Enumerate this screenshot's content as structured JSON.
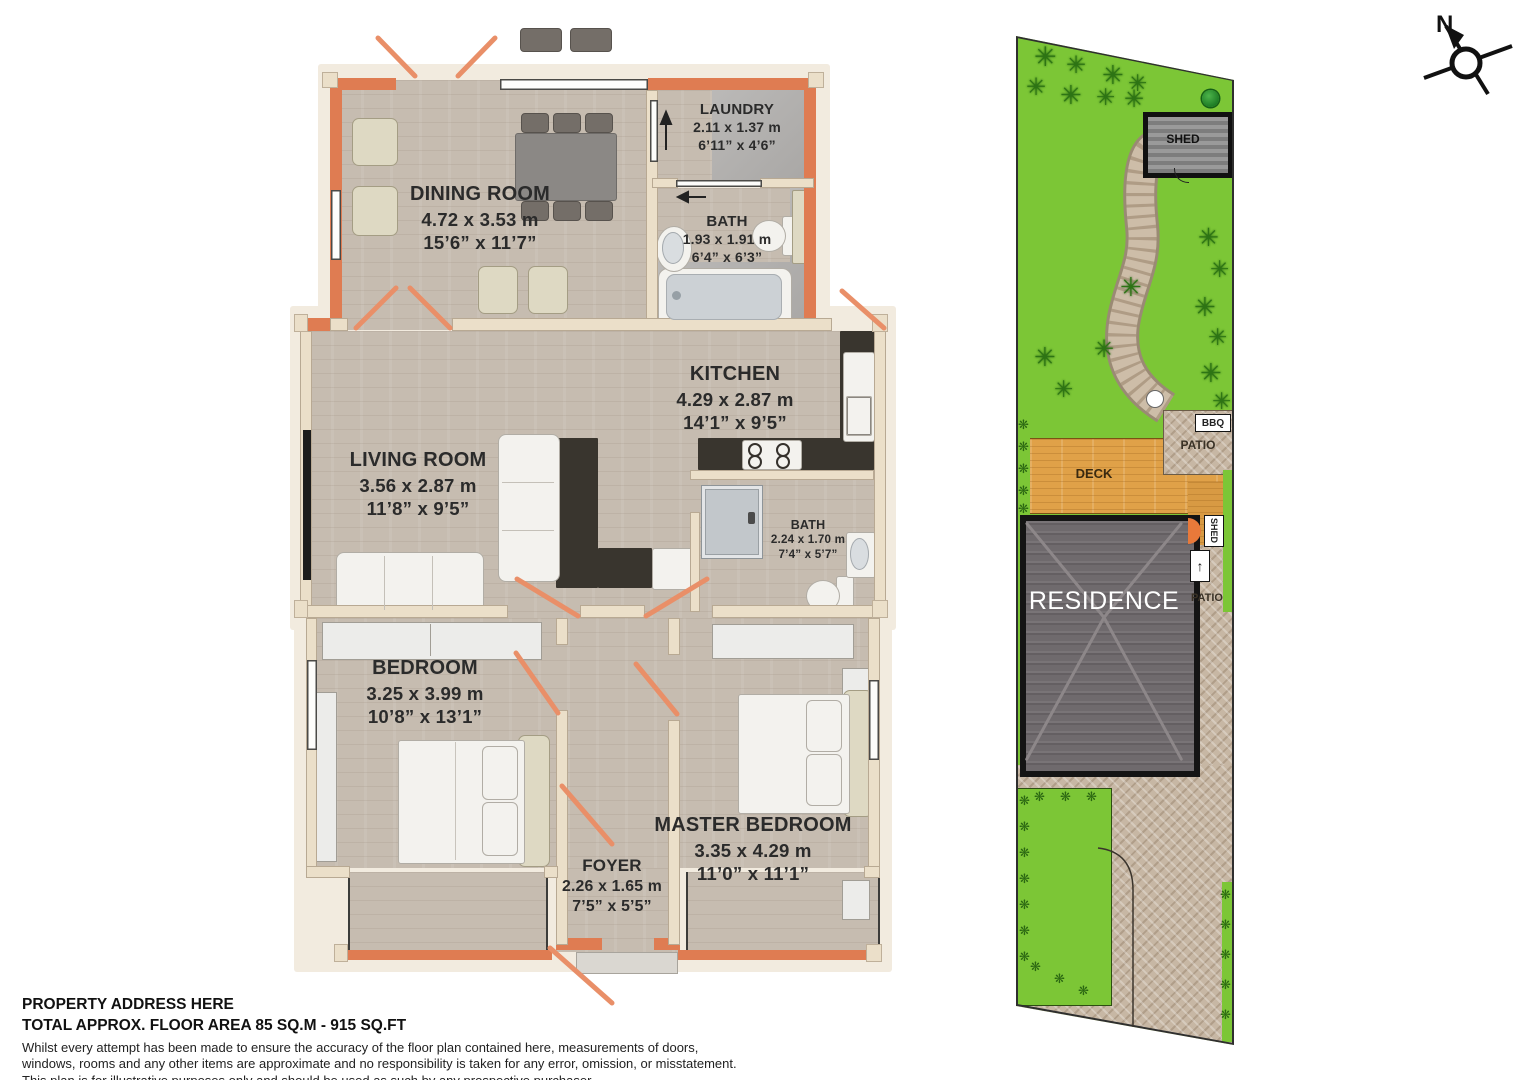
{
  "floor_plan": {
    "rooms": [
      {
        "name": "DINING ROOM",
        "metric": "4.72 x 3.53 m",
        "imperial": "15’6” x 11’7”"
      },
      {
        "name": "LAUNDRY",
        "metric": "2.11 x 1.37 m",
        "imperial": "6’11” x 4’6”"
      },
      {
        "name": "BATH",
        "metric": "1.93 x 1.91 m",
        "imperial": "6’4” x 6’3”"
      },
      {
        "name": "KITCHEN",
        "metric": "4.29 x 2.87 m",
        "imperial": "14’1” x 9’5”"
      },
      {
        "name": "LIVING ROOM",
        "metric": "3.56 x 2.87 m",
        "imperial": "11’8” x 9’5”"
      },
      {
        "name": "BATH",
        "metric": "2.24 x 1.70 m",
        "imperial": "7’4” x 5’7”"
      },
      {
        "name": "BEDROOM",
        "metric": "3.25 x 3.99 m",
        "imperial": "10’8” x 13’1”"
      },
      {
        "name": "MASTER BEDROOM",
        "metric": "3.35 x 4.29 m",
        "imperial": "11’0” x 11’1”"
      },
      {
        "name": "FOYER",
        "metric": "2.26 x 1.65 m",
        "imperial": "7’5” x 5’5”"
      }
    ]
  },
  "site_plan": {
    "shed_label": "SHED",
    "bbq_label": "BBQ",
    "patio_upper_label": "PATIO",
    "deck_label": "DECK",
    "residence_label": "RESIDENCE",
    "shed_side_label": "SHED",
    "patio_side_label": "PATIO",
    "tree_glyph": "✳",
    "plant_glyph": "❋",
    "arrow_up_glyph": "↑"
  },
  "compass": {
    "north_label": "N"
  },
  "footer": {
    "address": "PROPERTY ADDRESS HERE",
    "area_line": "TOTAL APPROX. FLOOR AREA 85 SQ.M - 915 SQ.FT",
    "disclaimer_lines": [
      "Whilst every attempt has been made to ensure the accuracy of the floor plan contained here, measurements of doors,",
      "windows, rooms and any other items are approximate and no responsibility is taken for any error, omission, or misstatement.",
      "This plan is for illustrative purposes only and should be used as such by any prospective purchaser."
    ]
  },
  "colors": {
    "exterior_wall": "#df7c52",
    "interior_wall": "#ebdfc9",
    "lawn": "#7cc636",
    "deck": "#e0a148",
    "counter": "#39352e",
    "door_swing": "#e98f68"
  }
}
